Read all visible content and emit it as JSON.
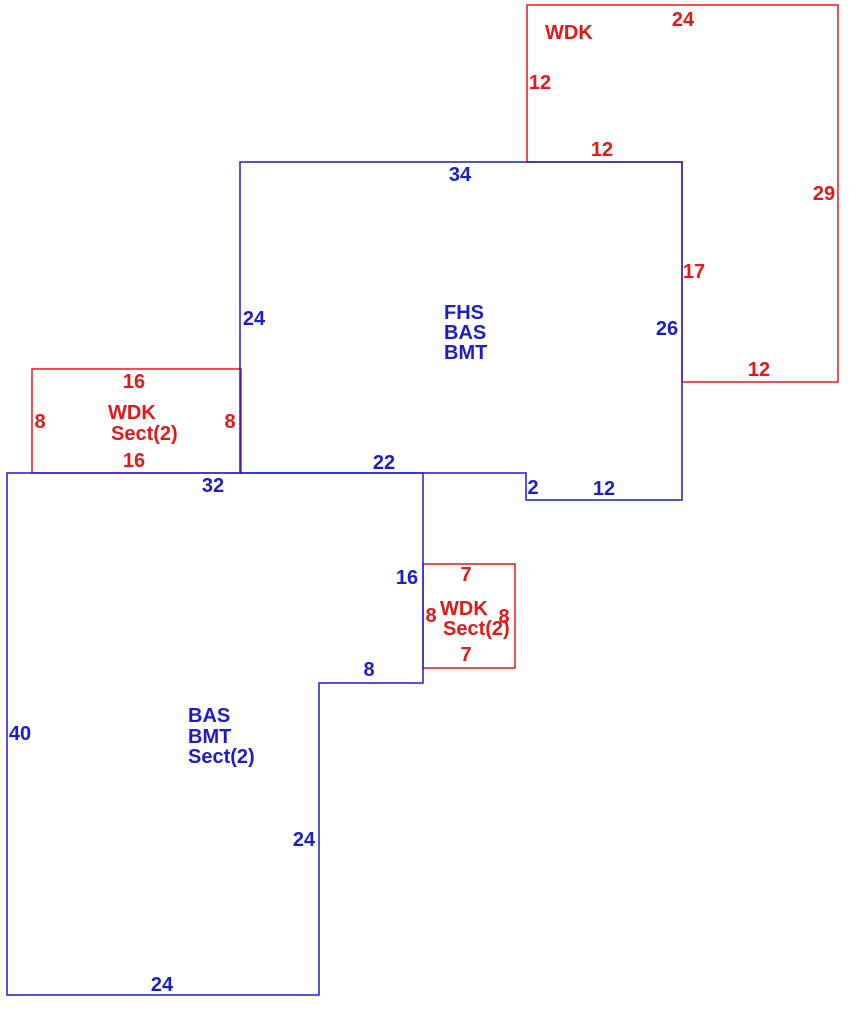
{
  "diagram": {
    "title": "Property appraisal floor-plan sketch",
    "canvas": {
      "width": 866,
      "height": 1015,
      "background": "#ffffff"
    },
    "colors": {
      "blue": "#1c1ccc",
      "red": "#e81717"
    },
    "stroke_width": 1.5,
    "font_size": 20,
    "shapes": [
      {
        "name": "wdk-deck-top",
        "area_code": "WDK",
        "color": "red",
        "points": [
          [
            527,
            5
          ],
          [
            838,
            5
          ],
          [
            838,
            382
          ],
          [
            682,
            382
          ],
          [
            682,
            162
          ],
          [
            527,
            162
          ]
        ]
      },
      {
        "name": "wdk-sect2-deck-left",
        "area_code": "WDK Sect(2)",
        "color": "red",
        "points": [
          [
            32,
            369
          ],
          [
            241,
            369
          ],
          [
            241,
            473
          ],
          [
            32,
            473
          ]
        ]
      },
      {
        "name": "wdk-sect2-deck-small",
        "area_code": "WDK Sect(2)",
        "color": "red",
        "points": [
          [
            423,
            564
          ],
          [
            515,
            564
          ],
          [
            515,
            668
          ],
          [
            423,
            668
          ]
        ]
      },
      {
        "name": "fhs-bas-bmt-area",
        "area_code": "FHS BAS BMT",
        "color": "blue",
        "points": [
          [
            240,
            162
          ],
          [
            682,
            162
          ],
          [
            682,
            500
          ],
          [
            526,
            500
          ],
          [
            526,
            473
          ],
          [
            240,
            473
          ]
        ]
      },
      {
        "name": "bas-bmt-sect2-area",
        "area_code": "BAS BMT Sect(2)",
        "color": "blue",
        "points": [
          [
            7,
            473
          ],
          [
            423,
            473
          ],
          [
            423,
            683
          ],
          [
            319,
            683
          ],
          [
            319,
            995
          ],
          [
            7,
            995
          ]
        ]
      }
    ],
    "labels": [
      {
        "name": "dimension-label",
        "text": "24",
        "x": 683,
        "y": 19,
        "color": "red"
      },
      {
        "name": "area-code-label",
        "text": "WDK",
        "x": 545,
        "y": 32,
        "color": "red",
        "anchor": "start"
      },
      {
        "name": "dimension-label",
        "text": "12",
        "x": 540,
        "y": 82,
        "color": "red"
      },
      {
        "name": "dimension-label",
        "text": "12",
        "x": 602,
        "y": 149,
        "color": "red"
      },
      {
        "name": "dimension-label",
        "text": "29",
        "x": 824,
        "y": 193,
        "color": "red"
      },
      {
        "name": "dimension-label",
        "text": "17",
        "x": 694,
        "y": 271,
        "color": "red"
      },
      {
        "name": "dimension-label",
        "text": "12",
        "x": 759,
        "y": 369,
        "color": "red"
      },
      {
        "name": "dimension-label",
        "text": "16",
        "x": 134,
        "y": 381,
        "color": "red"
      },
      {
        "name": "area-code-label",
        "text": "WDK",
        "x": 108,
        "y": 412,
        "color": "red",
        "anchor": "start"
      },
      {
        "name": "area-code-label",
        "text": "Sect(2)",
        "x": 111,
        "y": 433,
        "color": "red",
        "anchor": "start"
      },
      {
        "name": "dimension-label",
        "text": "8",
        "x": 40,
        "y": 421,
        "color": "red"
      },
      {
        "name": "dimension-label",
        "text": "8",
        "x": 230,
        "y": 421,
        "color": "red"
      },
      {
        "name": "dimension-label",
        "text": "16",
        "x": 134,
        "y": 460,
        "color": "red"
      },
      {
        "name": "dimension-label",
        "text": "7",
        "x": 466,
        "y": 574,
        "color": "red"
      },
      {
        "name": "dimension-label",
        "text": "8",
        "x": 431,
        "y": 615,
        "color": "red"
      },
      {
        "name": "area-code-label",
        "text": "WDK",
        "x": 440,
        "y": 608,
        "color": "red",
        "anchor": "start"
      },
      {
        "name": "area-code-label",
        "text": "Sect(2)",
        "x": 443,
        "y": 628,
        "color": "red",
        "anchor": "start"
      },
      {
        "name": "dimension-label",
        "text": "8",
        "x": 504,
        "y": 616,
        "color": "red"
      },
      {
        "name": "dimension-label",
        "text": "7",
        "x": 466,
        "y": 654,
        "color": "red"
      },
      {
        "name": "dimension-label",
        "text": "34",
        "x": 460,
        "y": 174,
        "color": "blue"
      },
      {
        "name": "dimension-label",
        "text": "24",
        "x": 254,
        "y": 318,
        "color": "blue"
      },
      {
        "name": "area-code-label",
        "text": "FHS",
        "x": 444,
        "y": 312,
        "color": "blue",
        "anchor": "start"
      },
      {
        "name": "area-code-label",
        "text": "BAS",
        "x": 444,
        "y": 332,
        "color": "blue",
        "anchor": "start"
      },
      {
        "name": "area-code-label",
        "text": "BMT",
        "x": 444,
        "y": 352,
        "color": "blue",
        "anchor": "start"
      },
      {
        "name": "dimension-label",
        "text": "26",
        "x": 667,
        "y": 328,
        "color": "blue"
      },
      {
        "name": "dimension-label",
        "text": "22",
        "x": 384,
        "y": 462,
        "color": "blue"
      },
      {
        "name": "dimension-label",
        "text": "2",
        "x": 533,
        "y": 487,
        "color": "blue"
      },
      {
        "name": "dimension-label",
        "text": "12",
        "x": 604,
        "y": 488,
        "color": "blue"
      },
      {
        "name": "dimension-label",
        "text": "32",
        "x": 213,
        "y": 485,
        "color": "blue"
      },
      {
        "name": "dimension-label",
        "text": "16",
        "x": 407,
        "y": 577,
        "color": "blue"
      },
      {
        "name": "dimension-label",
        "text": "8",
        "x": 369,
        "y": 669,
        "color": "blue"
      },
      {
        "name": "dimension-label",
        "text": "40",
        "x": 20,
        "y": 733,
        "color": "blue"
      },
      {
        "name": "area-code-label",
        "text": "BAS",
        "x": 188,
        "y": 715,
        "color": "blue",
        "anchor": "start"
      },
      {
        "name": "area-code-label",
        "text": "BMT",
        "x": 188,
        "y": 736,
        "color": "blue",
        "anchor": "start"
      },
      {
        "name": "area-code-label",
        "text": "Sect(2)",
        "x": 188,
        "y": 756,
        "color": "blue",
        "anchor": "start"
      },
      {
        "name": "dimension-label",
        "text": "24",
        "x": 304,
        "y": 839,
        "color": "blue"
      },
      {
        "name": "dimension-label",
        "text": "24",
        "x": 162,
        "y": 984,
        "color": "blue"
      }
    ]
  }
}
